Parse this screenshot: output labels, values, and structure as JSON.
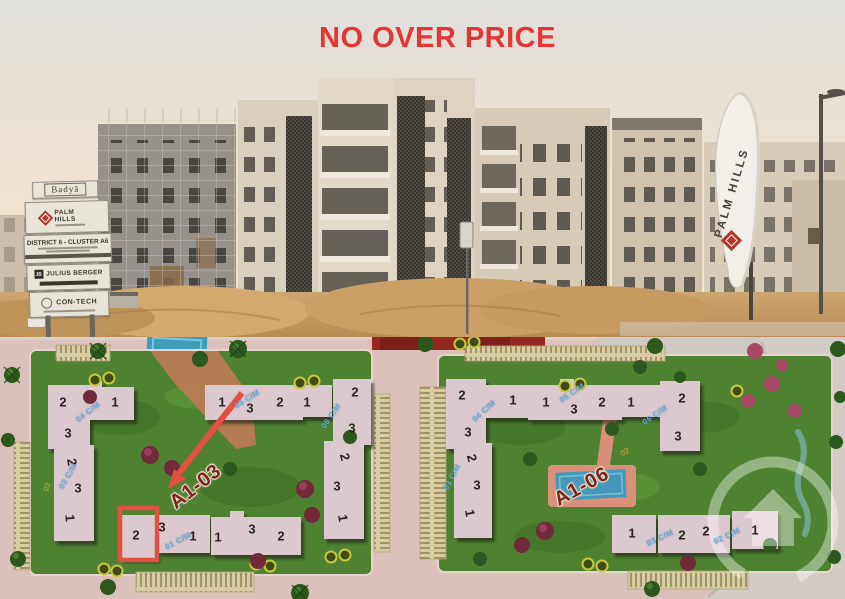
{
  "headline": {
    "text": "NO OVER PRICE"
  },
  "colors": {
    "headline_red": "#e43434",
    "highlight_red": "#e2503f",
    "cluster_label_maroon": "#7a241f",
    "unit_label_blue": "#66aed8"
  },
  "photo": {
    "billboard": {
      "project": "Badyā",
      "developer": "PALM HILLS",
      "developer_sub": "DEVELOPMENTS",
      "location": "DISTRICT 6 - CLUSTER A6",
      "contractor1": "JULIUS BERGER",
      "contractor1_logo": "JB",
      "contractor2": "CON-TECH"
    },
    "flag_label": "PALM HILLS"
  },
  "map": {
    "clusters": [
      {
        "label": "A1-03",
        "x": 196,
        "y": 487,
        "rot": -38
      },
      {
        "label": "A1-06",
        "x": 582,
        "y": 487,
        "rot": -29
      }
    ],
    "highlight": {
      "building": "2",
      "cluster": "A1-03"
    },
    "building_numbers": [
      {
        "n": "2",
        "x": 63,
        "y": 402
      },
      {
        "n": "1",
        "x": 115,
        "y": 402
      },
      {
        "n": "3",
        "x": 68,
        "y": 433
      },
      {
        "n": "1",
        "x": 222,
        "y": 402
      },
      {
        "n": "3",
        "x": 250,
        "y": 408
      },
      {
        "n": "2",
        "x": 280,
        "y": 402
      },
      {
        "n": "1",
        "x": 307,
        "y": 402
      },
      {
        "n": "2",
        "x": 355,
        "y": 392
      },
      {
        "n": "3",
        "x": 352,
        "y": 428
      },
      {
        "n": "2",
        "x": 72,
        "y": 462,
        "rot": 80
      },
      {
        "n": "3",
        "x": 78,
        "y": 488
      },
      {
        "n": "1",
        "x": 70,
        "y": 518,
        "rot": 85
      },
      {
        "n": "2",
        "x": 345,
        "y": 457,
        "rot": 75
      },
      {
        "n": "3",
        "x": 337,
        "y": 486
      },
      {
        "n": "1",
        "x": 343,
        "y": 518,
        "rot": 80
      },
      {
        "n": "2",
        "x": 136,
        "y": 535
      },
      {
        "n": "3",
        "x": 162,
        "y": 527
      },
      {
        "n": "1",
        "x": 193,
        "y": 536
      },
      {
        "n": "1",
        "x": 218,
        "y": 537
      },
      {
        "n": "3",
        "x": 252,
        "y": 529
      },
      {
        "n": "2",
        "x": 281,
        "y": 536
      },
      {
        "n": "2",
        "x": 462,
        "y": 395
      },
      {
        "n": "1",
        "x": 513,
        "y": 400
      },
      {
        "n": "3",
        "x": 468,
        "y": 432
      },
      {
        "n": "1",
        "x": 546,
        "y": 402
      },
      {
        "n": "3",
        "x": 574,
        "y": 409
      },
      {
        "n": "2",
        "x": 602,
        "y": 402
      },
      {
        "n": "1",
        "x": 631,
        "y": 402
      },
      {
        "n": "2",
        "x": 682,
        "y": 398
      },
      {
        "n": "3",
        "x": 678,
        "y": 436
      },
      {
        "n": "2",
        "x": 472,
        "y": 458,
        "rot": 75
      },
      {
        "n": "3",
        "x": 477,
        "y": 485
      },
      {
        "n": "1",
        "x": 470,
        "y": 513,
        "rot": 80
      },
      {
        "n": "1",
        "x": 632,
        "y": 533
      },
      {
        "n": "2",
        "x": 682,
        "y": 535
      },
      {
        "n": "2",
        "x": 706,
        "y": 531
      },
      {
        "n": "1",
        "x": 755,
        "y": 530
      }
    ],
    "unit_labels": [
      {
        "t": "04 C/M",
        "x": 88,
        "y": 412,
        "rot": -38
      },
      {
        "t": "05 C/M",
        "x": 247,
        "y": 399,
        "rot": -32
      },
      {
        "t": "06 C/M",
        "x": 331,
        "y": 416,
        "rot": -55
      },
      {
        "t": "03 C/M",
        "x": 68,
        "y": 476,
        "rot": -60
      },
      {
        "t": "01 C/M",
        "x": 178,
        "y": 541,
        "rot": -28
      },
      {
        "t": "04 C/M",
        "x": 484,
        "y": 411,
        "rot": -42
      },
      {
        "t": "05 C/M",
        "x": 572,
        "y": 393,
        "rot": -35
      },
      {
        "t": "06 C/M",
        "x": 655,
        "y": 415,
        "rot": -35
      },
      {
        "t": "03 C/M",
        "x": 452,
        "y": 477,
        "rot": -62
      },
      {
        "t": "03 C/M",
        "x": 660,
        "y": 538,
        "rot": -25
      },
      {
        "t": "02 C/M",
        "x": 727,
        "y": 536,
        "rot": -25
      }
    ],
    "yellow_labels": [
      {
        "t": "03",
        "x": 47,
        "y": 487,
        "rot": -70
      },
      {
        "t": "02",
        "x": 625,
        "y": 452,
        "rot": -30
      }
    ]
  }
}
